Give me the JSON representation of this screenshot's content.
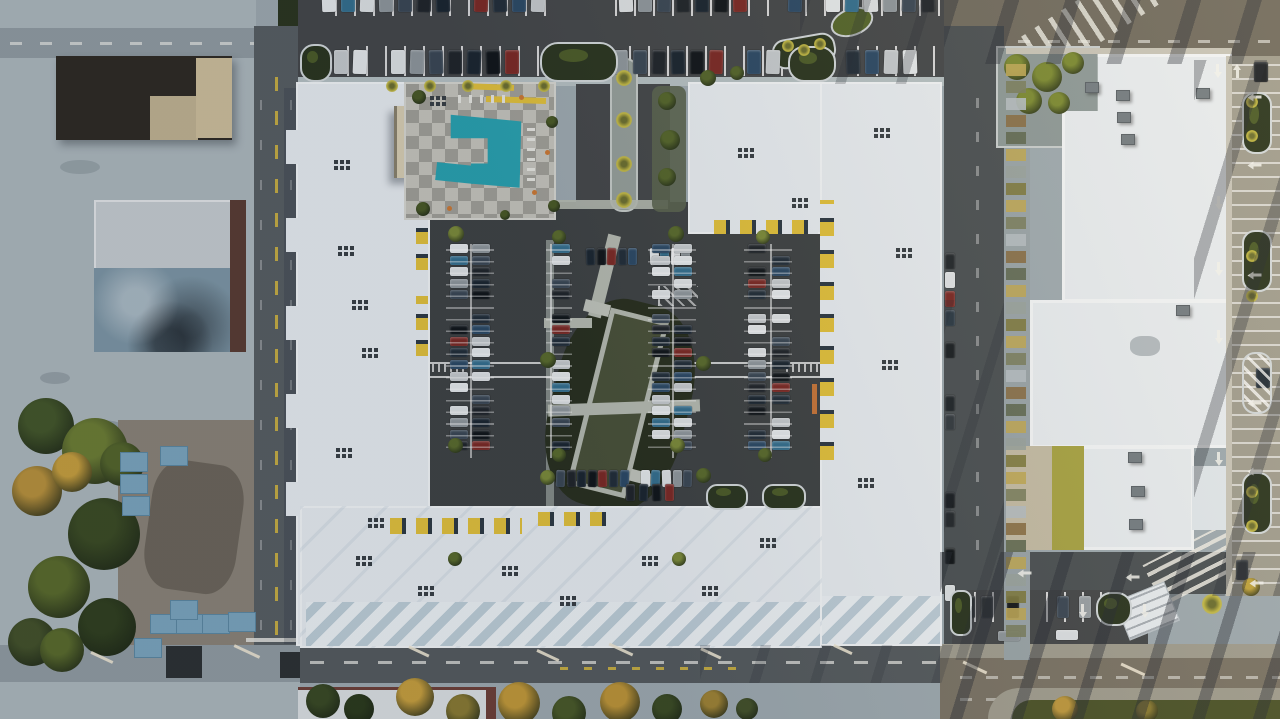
{
  "scene": {
    "type": "aerial-photograph",
    "title": "Top-down aerial view of a white apartment complex ring with interior courtyard parking, swimming pool and surrounding streets at golden hour",
    "time_of_day": "late afternoon, long warm shadows from the right",
    "setting": "mixed residential and commercial blocks, no visible text in image"
  },
  "palette": {
    "base": "#9fabb1",
    "concrete": "#aeb9be",
    "concrete_warm": "#a19e90",
    "asphalt_lot": "#45484a",
    "asphalt_court": "#3f4344",
    "road": "#585f63",
    "road_light": "#929da3",
    "road_mid": "#565c5f",
    "road_warm": "#716c60",
    "road_warm2": "#7b7466",
    "street_right": "#4b5154",
    "roof_white": "#e9eef2",
    "roof_bright": "#f4f7f9",
    "roof_shade": "#bfcfd9",
    "roof_dark": "#2f2b24",
    "roof_tan": "#cfc09c",
    "roof_blue": "#7e97a6",
    "roof_gray": "#c8ced2",
    "brick": "#5a3d33",
    "pool": "#2aa3b1",
    "deck_a": "#c7c6be",
    "deck_b": "#a2a199",
    "yellow": "#e3c23c",
    "orange": "#cd7a35",
    "green_dark": "#2b3620",
    "green_olive": "#55662b",
    "green_gold": "#b9923c",
    "palm": "#c5bb45",
    "dirt": "#8b8478",
    "mulch": "#29301f",
    "lawn": "#4a5239",
    "container": "#7ca6bf",
    "curb": "#d3d9db",
    "glint": "#f0e8d4",
    "olive_roof": "#a8a444",
    "tan_roof": "#c5bda6"
  },
  "features": {
    "swimming_pool": {
      "color": "#2aa3b1",
      "deck": "gray checkerboard paving with white loungers and orange umbrellas"
    },
    "apartment_complex": {
      "roof_color": "#e9eef2",
      "accent_color": "#e3c23c",
      "shape": "closed ring of white roofs around a dark asphalt parking courtyard"
    },
    "center_garden": {
      "lawn_color": "#4a5239",
      "border": "light paved walkways, tilted strip"
    },
    "vehicles": {
      "car_colors": [
        "#e6eaec",
        "#20252a",
        "#2c4a66",
        "#90989d",
        "#7c2a25",
        "#35708f",
        "#1b2630",
        "#c6cbce",
        "#3b4855",
        "#222e39",
        "#dfe3e5",
        "#11161a"
      ]
    }
  }
}
